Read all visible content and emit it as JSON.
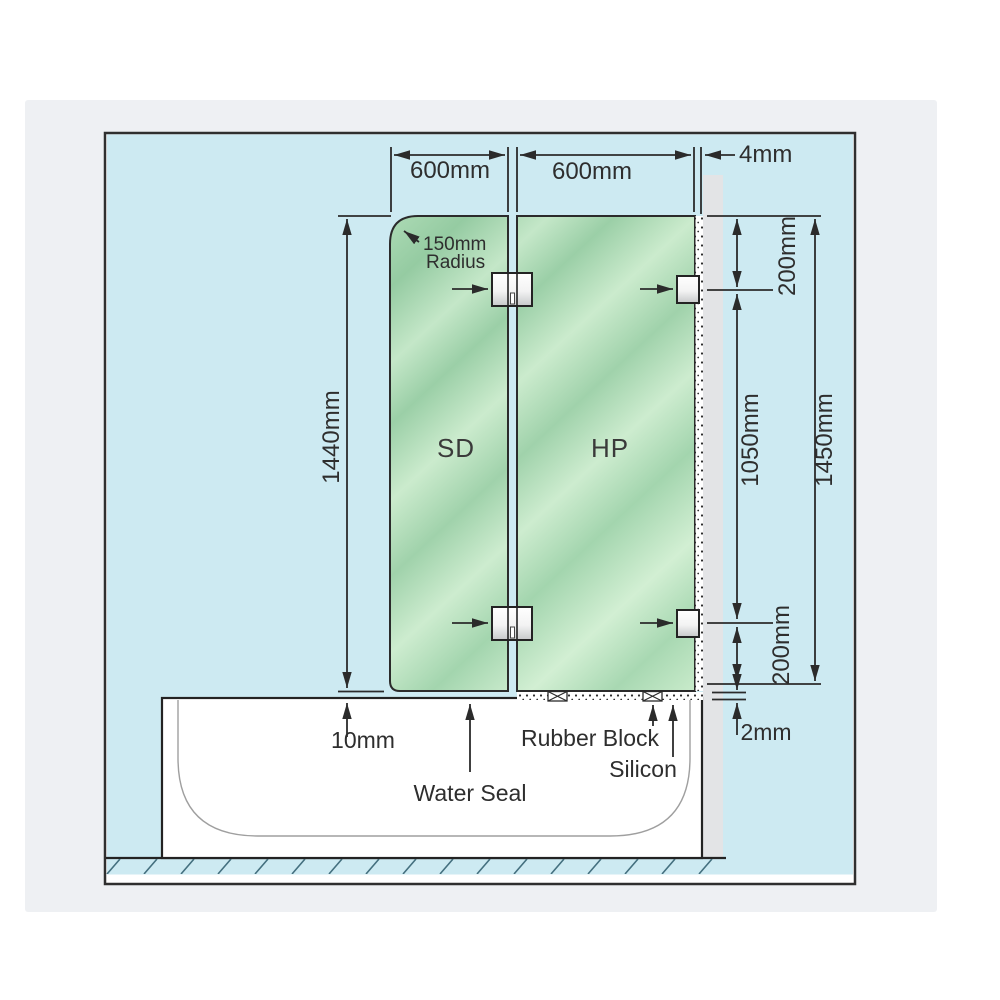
{
  "page": {
    "background": "#ffffff",
    "card_color": "#eef0f3"
  },
  "colors": {
    "diagram_bg": "#cdeaf2",
    "glass": "#a3d5ae",
    "glass_highlight": "#cfeed1",
    "wall": "#e3e4e6",
    "bath": "#ffffff",
    "line": "#2b2b2b",
    "hatch_line": "#44707f",
    "hardware": "#f3f3f3"
  },
  "diagram": {
    "panel_labels": {
      "shower_door": "SD",
      "hinged_panel": "HP"
    },
    "dimensions": {
      "sd_width": "600mm",
      "hp_width": "600mm",
      "wall_gap": "4mm",
      "corner_radius": "150mm",
      "corner_radius_caption": "Radius",
      "sd_height": "1440mm",
      "hp_height": "1450mm",
      "top_bracket_offset": "200mm",
      "bracket_span": "1050mm",
      "bottom_bracket_offset": "200mm",
      "floor_gap": "10mm",
      "base_gap": "2mm"
    },
    "annotations": {
      "water_seal": "Water Seal",
      "rubber_block": "Rubber Block",
      "silicon": "Silicon"
    }
  }
}
